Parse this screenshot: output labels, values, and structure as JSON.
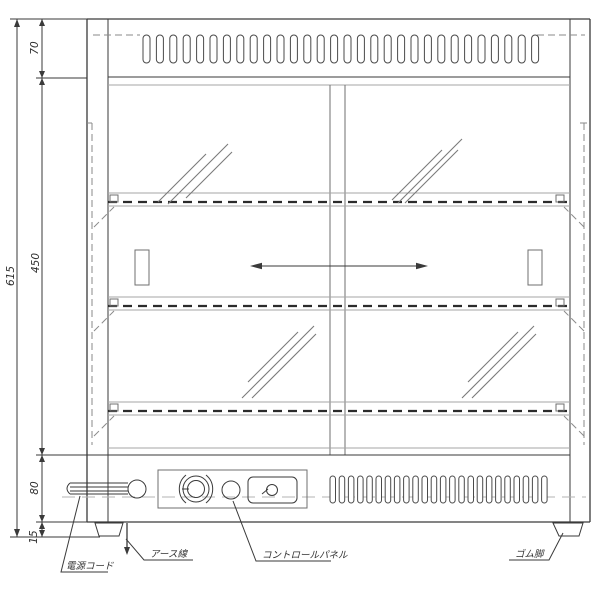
{
  "drawing": {
    "type": "appliance-front-elevation-technical-drawing",
    "background": "#ffffff",
    "line_color": "#3a3a3a"
  },
  "dimensions": {
    "overall_height": "615",
    "top_section": "70",
    "body_section": "450",
    "base_section": "80",
    "foot_height": "15"
  },
  "annotations": {
    "power_cord": "電源コード",
    "earth_wire": "アース線",
    "control_panel": "コントロールパネル",
    "rubber_foot": "ゴム脚"
  },
  "vents": {
    "top": {
      "x": 143,
      "y": 35,
      "count": 30,
      "pitch": 13.4,
      "slot_width": 7,
      "slot_height": 28
    },
    "bottom": {
      "x": 330,
      "y": 476,
      "count": 24,
      "pitch": 9.2,
      "slot_width": 5.5,
      "slot_height": 27
    }
  }
}
